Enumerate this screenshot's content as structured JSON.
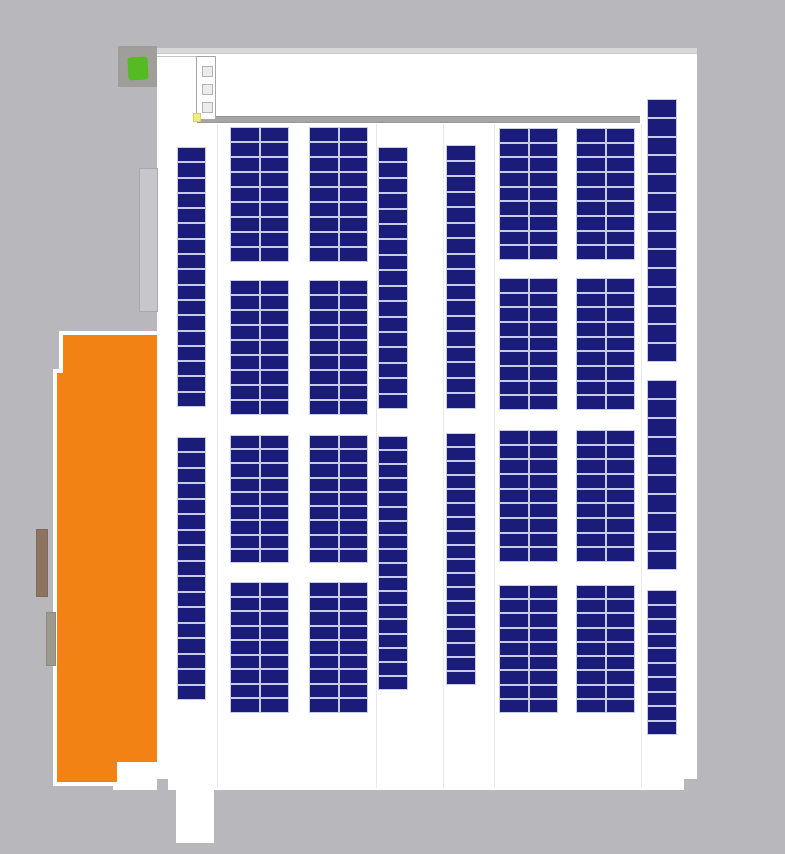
{
  "meta": {
    "app": "solar-pv-layout-plan",
    "description": "Rooftop solar panel placement site plan"
  },
  "canvas": {
    "width": 785,
    "height": 854
  },
  "colors": {
    "background_gray": "#b8b8bc",
    "roof_white": "#ffffff",
    "roof_top_strip": "#d8d8d8",
    "walkway_band": "#a5a5a5",
    "panel_navy": "#1b1b79",
    "panel_gap": "#c6cbe8",
    "orange_building": "#f28214",
    "building_outline_white": "#ffffff",
    "marker_box_gray": "#a09e9a",
    "marker_green": "#55bb22",
    "marker_yellow": "#eeec84",
    "annex_brown": "#8d7461",
    "annex_gray": "#9e998f",
    "side_rect_gray": "#c7c7cb",
    "section_line": "#e7e7eb",
    "structure_line": "#c4c4c8"
  },
  "roof": {
    "main": {
      "x": 157,
      "y": 48,
      "w": 540,
      "h": 731
    },
    "bottom_strip": {
      "x": 168,
      "y": 779,
      "w": 516,
      "h": 11
    },
    "protrusion": {
      "x": 176,
      "y": 790,
      "w": 38,
      "h": 53
    },
    "annex_white_a": {
      "x": 113,
      "y": 762,
      "w": 63,
      "h": 17
    },
    "annex_white_b": {
      "x": 113,
      "y": 779,
      "w": 44,
      "h": 11
    },
    "top_strip": {
      "x": 157,
      "y": 48,
      "w": 540,
      "h": 6
    },
    "walkway_band": {
      "x": 197,
      "y": 116,
      "w": 443,
      "h": 7
    },
    "top_line": {
      "x": 157,
      "y": 56,
      "w": 40,
      "h": 1
    },
    "section_lines_y": {
      "top": 124,
      "bottom": 788
    },
    "section_lines_x": [
      217,
      376,
      443,
      494,
      641
    ]
  },
  "buildings": {
    "orange": {
      "box": {
        "x": 53,
        "y": 331,
        "w": 104,
        "h": 455
      },
      "outline_points": [
        [
          6,
          0
        ],
        [
          104,
          0
        ],
        [
          104,
          435
        ],
        [
          68,
          435
        ],
        [
          68,
          455
        ],
        [
          0,
          455
        ],
        [
          0,
          38
        ],
        [
          6,
          38
        ]
      ],
      "fill_points": [
        [
          10,
          4
        ],
        [
          104,
          4
        ],
        [
          104,
          431
        ],
        [
          64,
          431
        ],
        [
          64,
          451
        ],
        [
          4,
          451
        ],
        [
          4,
          42
        ],
        [
          10,
          42
        ]
      ]
    },
    "annex_brown": {
      "x": 36,
      "y": 529,
      "w": 12,
      "h": 68
    },
    "annex_gray": {
      "x": 46,
      "y": 612,
      "w": 10,
      "h": 54
    },
    "side_rect": {
      "x": 139,
      "y": 168,
      "w": 19,
      "h": 144
    }
  },
  "markers": {
    "green_box": {
      "x": 118,
      "y": 46,
      "w": 39,
      "h": 41
    },
    "green_icon": {
      "x": 10,
      "y": 11,
      "w": 20,
      "h": 23
    },
    "yellow_dot": {
      "x": 193,
      "y": 113,
      "w": 8,
      "h": 9
    },
    "structure": {
      "x": 196,
      "y": 56,
      "w": 20,
      "h": 64
    },
    "structure_boxes": [
      {
        "x": 202,
        "y": 66,
        "w": 11,
        "h": 11
      },
      {
        "x": 202,
        "y": 84,
        "w": 11,
        "h": 11
      },
      {
        "x": 202,
        "y": 102,
        "w": 11,
        "h": 11
      }
    ]
  },
  "panel_arrays": [
    {
      "id": "col-a-group-1",
      "x": 177,
      "y": 147,
      "w": 29,
      "h": 260,
      "cols": 1,
      "rows": 17
    },
    {
      "id": "col-a-group-2",
      "x": 177,
      "y": 437,
      "w": 29,
      "h": 263,
      "cols": 1,
      "rows": 17
    },
    {
      "id": "col-b-group-1",
      "x": 230,
      "y": 127,
      "w": 59,
      "h": 135,
      "cols": 2,
      "rows": 9
    },
    {
      "id": "col-b-group-2",
      "x": 230,
      "y": 280,
      "w": 59,
      "h": 135,
      "cols": 2,
      "rows": 9
    },
    {
      "id": "col-b-group-3",
      "x": 230,
      "y": 435,
      "w": 59,
      "h": 128,
      "cols": 2,
      "rows": 9
    },
    {
      "id": "col-b-group-4",
      "x": 230,
      "y": 582,
      "w": 59,
      "h": 131,
      "cols": 2,
      "rows": 9
    },
    {
      "id": "col-c-group-1",
      "x": 309,
      "y": 127,
      "w": 59,
      "h": 135,
      "cols": 2,
      "rows": 9
    },
    {
      "id": "col-c-group-2",
      "x": 309,
      "y": 280,
      "w": 59,
      "h": 135,
      "cols": 2,
      "rows": 9
    },
    {
      "id": "col-c-group-3",
      "x": 309,
      "y": 435,
      "w": 59,
      "h": 128,
      "cols": 2,
      "rows": 9
    },
    {
      "id": "col-c-group-4",
      "x": 309,
      "y": 582,
      "w": 59,
      "h": 131,
      "cols": 2,
      "rows": 9
    },
    {
      "id": "col-d-group-1",
      "x": 378,
      "y": 147,
      "w": 30,
      "h": 262,
      "cols": 1,
      "rows": 17
    },
    {
      "id": "col-d-group-2",
      "x": 378,
      "y": 436,
      "w": 30,
      "h": 254,
      "cols": 1,
      "rows": 18
    },
    {
      "id": "col-e-group-1",
      "x": 446,
      "y": 145,
      "w": 30,
      "h": 264,
      "cols": 1,
      "rows": 17
    },
    {
      "id": "col-e-group-2",
      "x": 446,
      "y": 433,
      "w": 30,
      "h": 252,
      "cols": 1,
      "rows": 18
    },
    {
      "id": "col-f-group-1",
      "x": 499,
      "y": 128,
      "w": 59,
      "h": 132,
      "cols": 2,
      "rows": 9
    },
    {
      "id": "col-f-group-2",
      "x": 499,
      "y": 278,
      "w": 59,
      "h": 132,
      "cols": 2,
      "rows": 9
    },
    {
      "id": "col-f-group-3",
      "x": 499,
      "y": 430,
      "w": 59,
      "h": 132,
      "cols": 2,
      "rows": 9
    },
    {
      "id": "col-f-group-4",
      "x": 499,
      "y": 585,
      "w": 59,
      "h": 128,
      "cols": 2,
      "rows": 9
    },
    {
      "id": "col-g-group-1",
      "x": 576,
      "y": 128,
      "w": 59,
      "h": 132,
      "cols": 2,
      "rows": 9
    },
    {
      "id": "col-g-group-2",
      "x": 576,
      "y": 278,
      "w": 59,
      "h": 132,
      "cols": 2,
      "rows": 9
    },
    {
      "id": "col-g-group-3",
      "x": 576,
      "y": 430,
      "w": 59,
      "h": 132,
      "cols": 2,
      "rows": 9
    },
    {
      "id": "col-g-group-4",
      "x": 576,
      "y": 585,
      "w": 59,
      "h": 128,
      "cols": 2,
      "rows": 9
    },
    {
      "id": "col-h-group-1",
      "x": 647,
      "y": 99,
      "w": 30,
      "h": 263,
      "cols": 1,
      "rows": 14
    },
    {
      "id": "col-h-group-2",
      "x": 647,
      "y": 380,
      "w": 30,
      "h": 190,
      "cols": 1,
      "rows": 10
    },
    {
      "id": "col-h-group-3",
      "x": 647,
      "y": 590,
      "w": 30,
      "h": 145,
      "cols": 1,
      "rows": 10
    }
  ]
}
